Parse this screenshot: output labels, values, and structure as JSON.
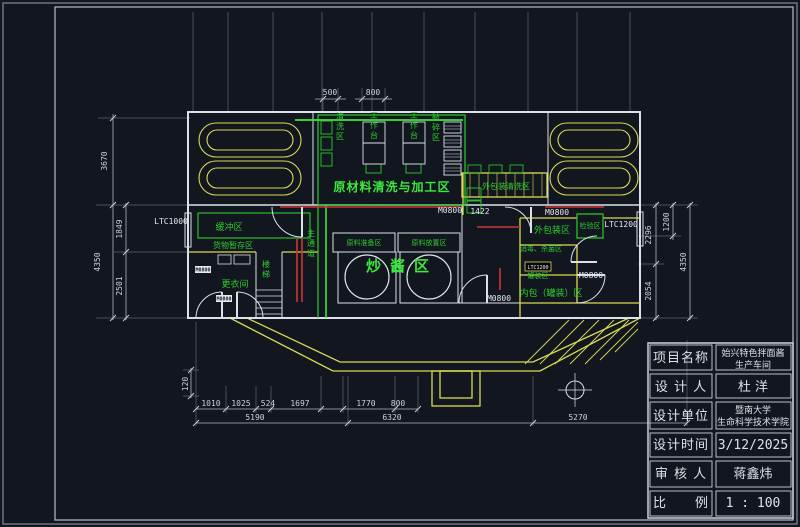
{
  "colors": {
    "background": "#12161f",
    "wall": "#dce1e8",
    "partition": "#d9da55",
    "label_green": "#2ecc2e",
    "alert_red": "#cd3434",
    "dim_text": "#ccd2da"
  },
  "areas": {
    "processing": "原材料清洗与加工区",
    "wash": "清洗区",
    "workbench": "工作台",
    "crush": "破碎区",
    "outer_pack_wash": "外包装清洗区",
    "buffer": "缓冲区",
    "goods_storage": "货物暂存区",
    "changing_room": "更衣间",
    "stairs": "楼梯",
    "corridor": "主通道",
    "material_prep": "原料准备区",
    "material_place": "原料放置区",
    "fry": "炒酱区",
    "outer_pack": "外包装区",
    "inspection": "检验区",
    "sterilize": "消毒、杀菌区",
    "filling": "罐装区",
    "inner_pack": "内包（罐装）区"
  },
  "tags": {
    "ltc1000": "LTC1000",
    "ltc1200": "LTC1200",
    "m0800": "M0800"
  },
  "dims": {
    "d500": "500",
    "d800t": "800",
    "d3670": "3670",
    "d4350l": "4350",
    "d1849": "1849",
    "d2501": "2501",
    "d2296": "2296",
    "d1200": "1200",
    "d4350r": "4350",
    "d2054": "2054",
    "d120": "120",
    "d1010": "1010",
    "d1025": "1025",
    "d524": "524",
    "d1697": "1697",
    "d1770": "1770",
    "d800b": "800",
    "d5190": "5190",
    "d6320": "6320",
    "d5270": "5270",
    "d1422": "1422"
  },
  "title_block": {
    "rows": [
      {
        "label": "项目名称",
        "value": "始兴特色拌面酱",
        "value2": "生产车间"
      },
      {
        "label": "设 计 人",
        "value": "杜 洋"
      },
      {
        "label": "设计单位",
        "value": "暨南大学",
        "value2": "生命科学技术学院"
      },
      {
        "label": "设计时间",
        "value": "3/12/2025"
      },
      {
        "label": "审 核 人",
        "value": "蒋鑫炜"
      },
      {
        "label": "比　　例",
        "value": "1 : 100"
      }
    ]
  }
}
